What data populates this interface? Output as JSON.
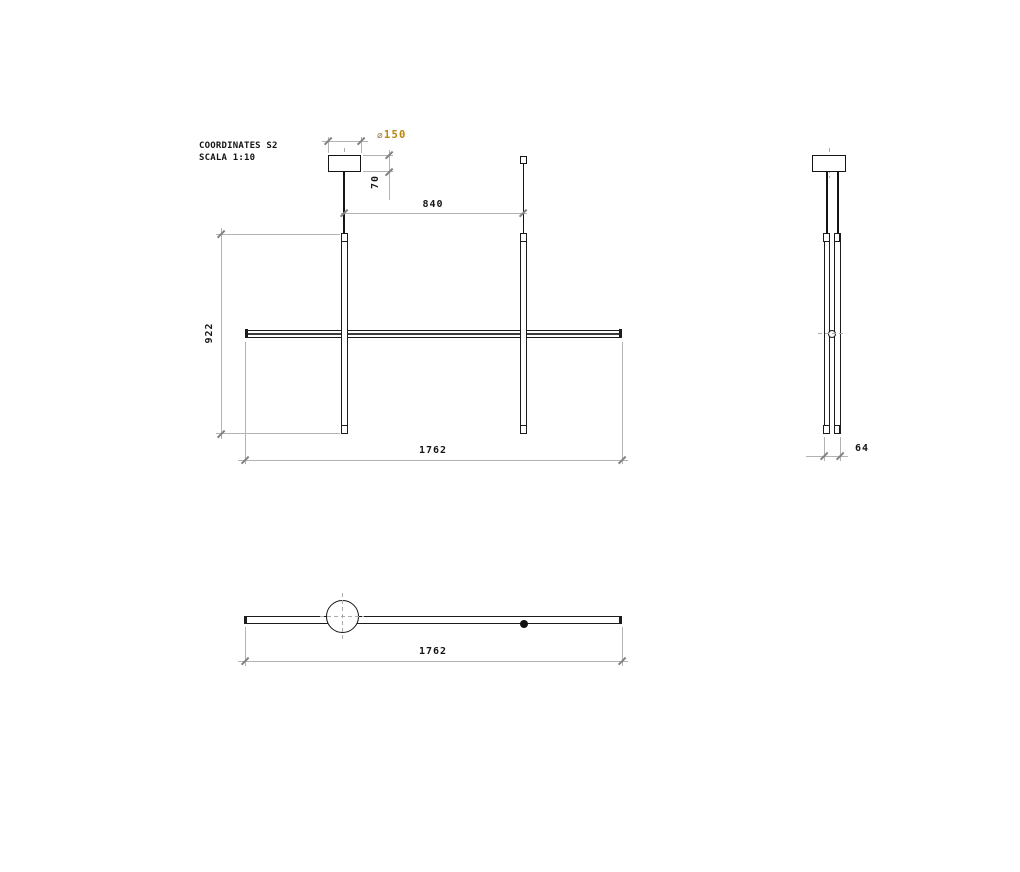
{
  "title_block": {
    "product": "COORDINATES S2",
    "scale": "SCALA 1:10"
  },
  "drawing": {
    "kind": "technical dimension drawing",
    "views": [
      "front",
      "side",
      "top"
    ]
  },
  "dims": {
    "canopy_diameter": {
      "symbol": "⌀",
      "value": "150"
    },
    "canopy_height": "70",
    "suspension_spacing": "840",
    "vertical_tube_height": "922",
    "overall_width_front": "1762",
    "side_depth": "64",
    "overall_width_top": "1762"
  },
  "colors": {
    "object_line": "#141414",
    "dimension_line": "#b3b3b3",
    "diameter_accent": "#b8860b"
  }
}
